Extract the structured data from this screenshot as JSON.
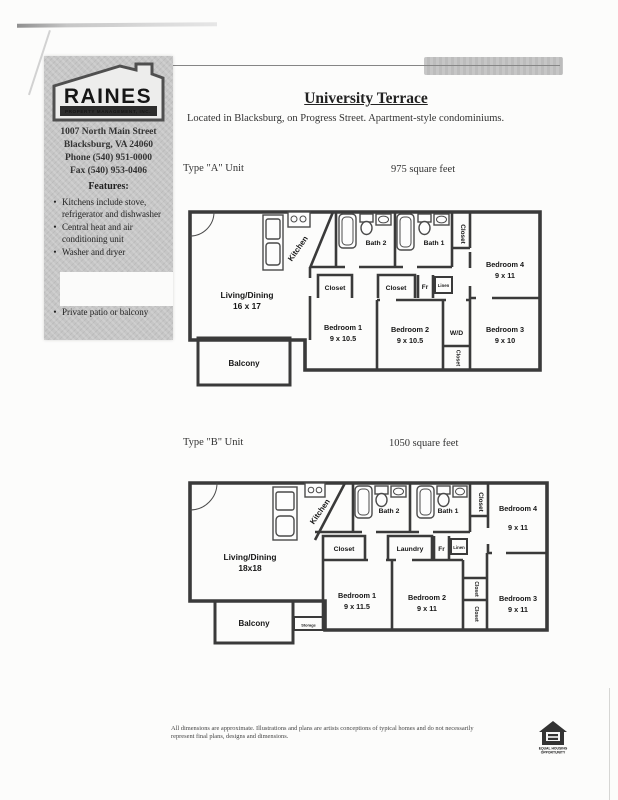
{
  "sidebar": {
    "logo": {
      "name": "RAINES",
      "subtitle": "PROPERTY MANAGEMENT, INC."
    },
    "address_lines": [
      "1007 North Main Street",
      "Blacksburg, VA 24060",
      "Phone  (540) 951-0000",
      "Fax (540) 953-0406"
    ],
    "features_title": "Features:",
    "bullet": "•",
    "features": [
      "Kitchens include stove, refrigerator and dishwasher",
      "Central heat and air conditioning unit",
      "Washer and dryer"
    ],
    "feature_extra": "Private patio or balcony"
  },
  "header": {
    "title": "University Terrace",
    "subtitle": "Located in Blacksburg, on Progress Street.  Apartment-style condominiums."
  },
  "plan_a": {
    "unit_label": "Type \"A\" Unit",
    "sqft": "975 square feet",
    "rooms": {
      "living": "Living/Dining",
      "living_dims": "16 x 17",
      "kitchen": "Kitchen",
      "bath2": "Bath 2",
      "bath1": "Bath 1",
      "closet_top": "Closet",
      "bedroom4": "Bedroom 4",
      "bedroom4_dims": "9 x 11",
      "closet1": "Closet",
      "closet2": "Closet",
      "fr": "Fr",
      "linen": "Linen",
      "bedroom1": "Bedroom 1",
      "bedroom1_dims": "9 x 10.5",
      "bedroom2": "Bedroom 2",
      "bedroom2_dims": "9 x 10.5",
      "wd": "W/D",
      "closet_wd": "Closet",
      "bedroom3": "Bedroom 3",
      "bedroom3_dims": "9 x 10",
      "balcony": "Balcony"
    }
  },
  "plan_b": {
    "unit_label": "Type \"B\" Unit",
    "sqft": "1050 square feet",
    "rooms": {
      "living": "Living/Dining",
      "living_dims": "18x18",
      "kitchen": "Kitchen",
      "bath2": "Bath 2",
      "bath1": "Bath 1",
      "closet_top": "Closet",
      "bedroom4": "Bedroom 4",
      "bedroom4_dims": "9 x 11",
      "closet1": "Closet",
      "laundry": "Laundry",
      "fr": "Fr",
      "linen": "Linen",
      "bedroom1": "Bedroom 1",
      "bedroom1_dims": "9 x 11.5",
      "bedroom2": "Bedroom 2",
      "bedroom2_dims": "9 x 11",
      "closet_mid": "Closet",
      "closet_low": "Closet",
      "bedroom3": "Bedroom 3",
      "bedroom3_dims": "9 x 11",
      "balcony": "Balcony",
      "storage": "Storage"
    }
  },
  "footer": {
    "disclaimer_line1": "All dimensions are approximate.  Illustrations and plans are artists conceptions of typical homes and do not necessarily",
    "disclaimer_line2": "represent final plans, designs and dimensions.",
    "eho_line1": "EQUAL HOUSING",
    "eho_line2": "OPPORTUNITY"
  }
}
